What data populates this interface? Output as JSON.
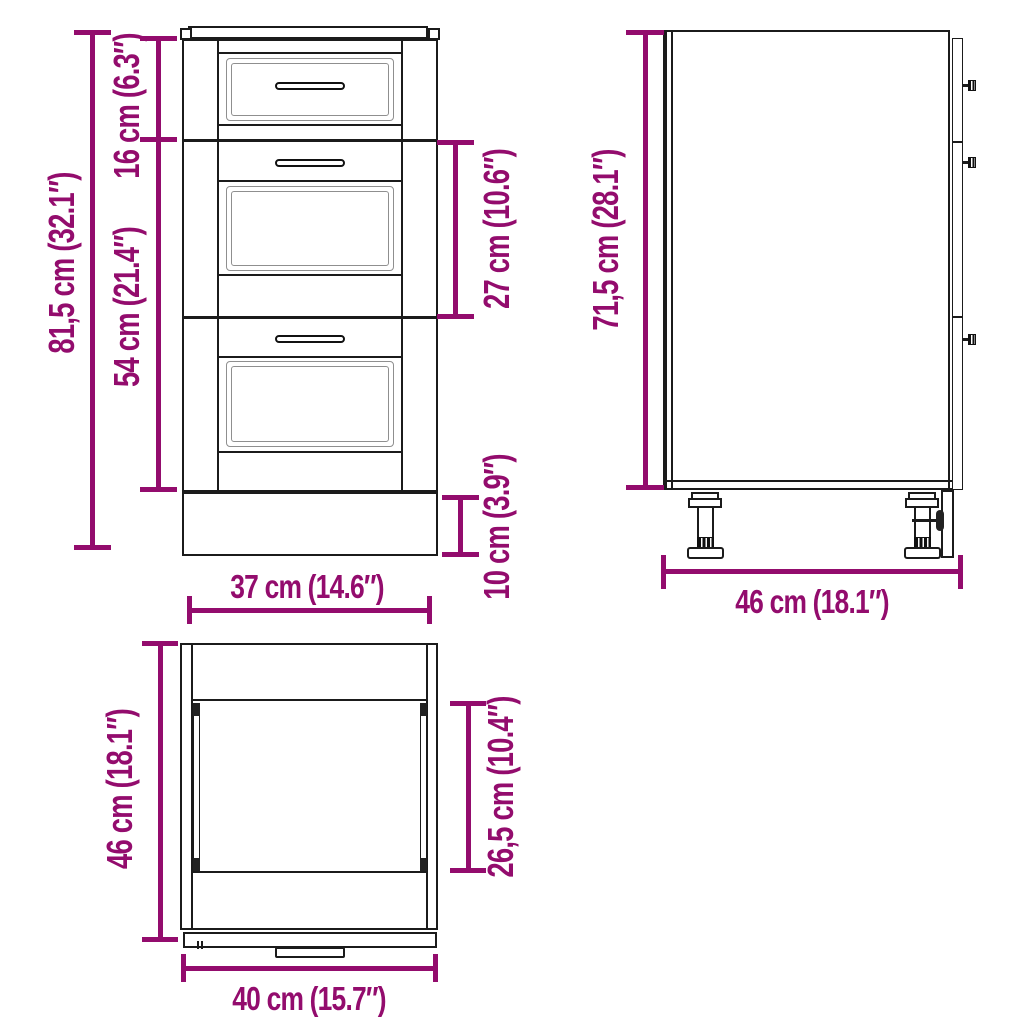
{
  "colors": {
    "accent": "#930C6D",
    "line": "#1B1B1B",
    "panel_frame": "#8F8F8F",
    "background": "#FFFFFF"
  },
  "views": {
    "front": {
      "dims": {
        "height_total": "81,5 cm (32.1″)",
        "top_drawer_height": "16 cm (6.3″)",
        "lower_drawers_height": "54 cm (21.4″)",
        "middle_drawer_height": "27 cm (10.6″)",
        "plinth_height": "10 cm (3.9″)",
        "front_width": "37 cm (14.6″)"
      }
    },
    "side": {
      "dims": {
        "body_height": "71,5 cm (28.1″)",
        "depth": "46 cm (18.1″)"
      }
    },
    "top": {
      "dims": {
        "depth": "46 cm (18.1″)",
        "inner_depth": "26,5 cm (10.4″)",
        "width": "40 cm (15.7″)"
      }
    }
  }
}
